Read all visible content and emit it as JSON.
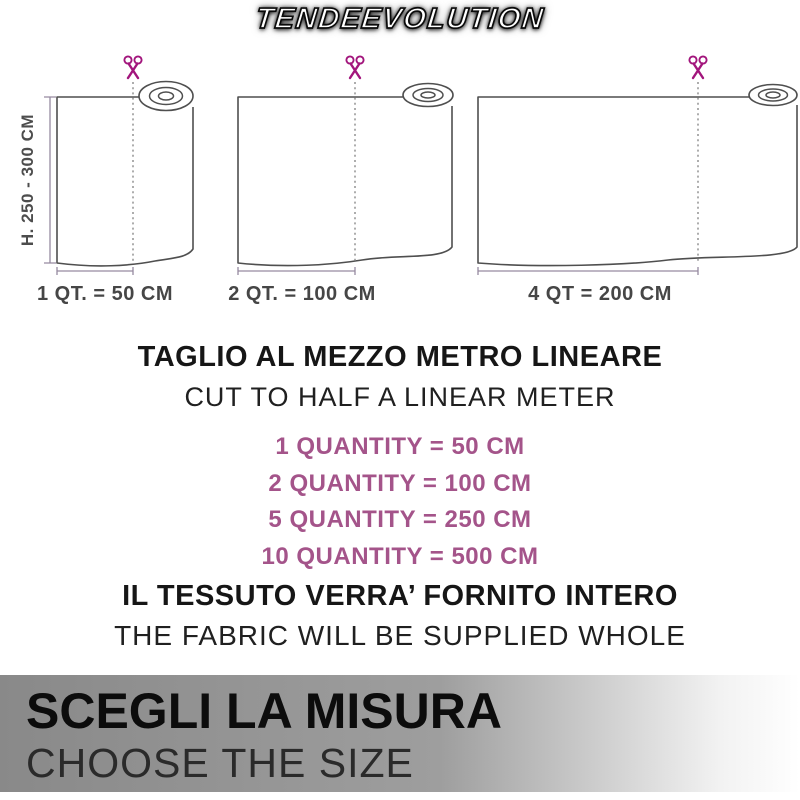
{
  "logo": {
    "text": "TENDEEVOLUTION"
  },
  "diagram": {
    "height_label": "H. 250 - 300 CM",
    "icons": {
      "scissors": "✂"
    },
    "rolls": [
      {
        "label": "1 QT. = 50 CM"
      },
      {
        "label": "2 QT. = 100 CM"
      },
      {
        "label": "4 QT = 200 CM"
      }
    ]
  },
  "info": {
    "title_it": "TAGLIO AL MEZZO METRO LINEARE",
    "title_en": "CUT TO HALF A LINEAR METER",
    "quantities": [
      "1 QUANTITY = 50 CM",
      "2 QUANTITY = 100 CM",
      "5 QUANTITY = 250 CM",
      "10 QUANTITY = 500 CM"
    ],
    "note_it": "IL TESSUTO VERRA’ FORNITO INTERO",
    "note_en": "THE FABRIC WILL BE SUPPLIED WHOLE"
  },
  "banner": {
    "title_it": "SCEGLI LA MISURA",
    "title_en": "CHOOSE THE SIZE"
  },
  "colors": {
    "accent_magenta": "#a2157c",
    "quantity_text": "#a4548a",
    "outline_gray": "#4f4f4f",
    "measure_line": "#968aa0",
    "banner_gradient_start": "#898989",
    "banner_gradient_end": "#ffffff"
  }
}
